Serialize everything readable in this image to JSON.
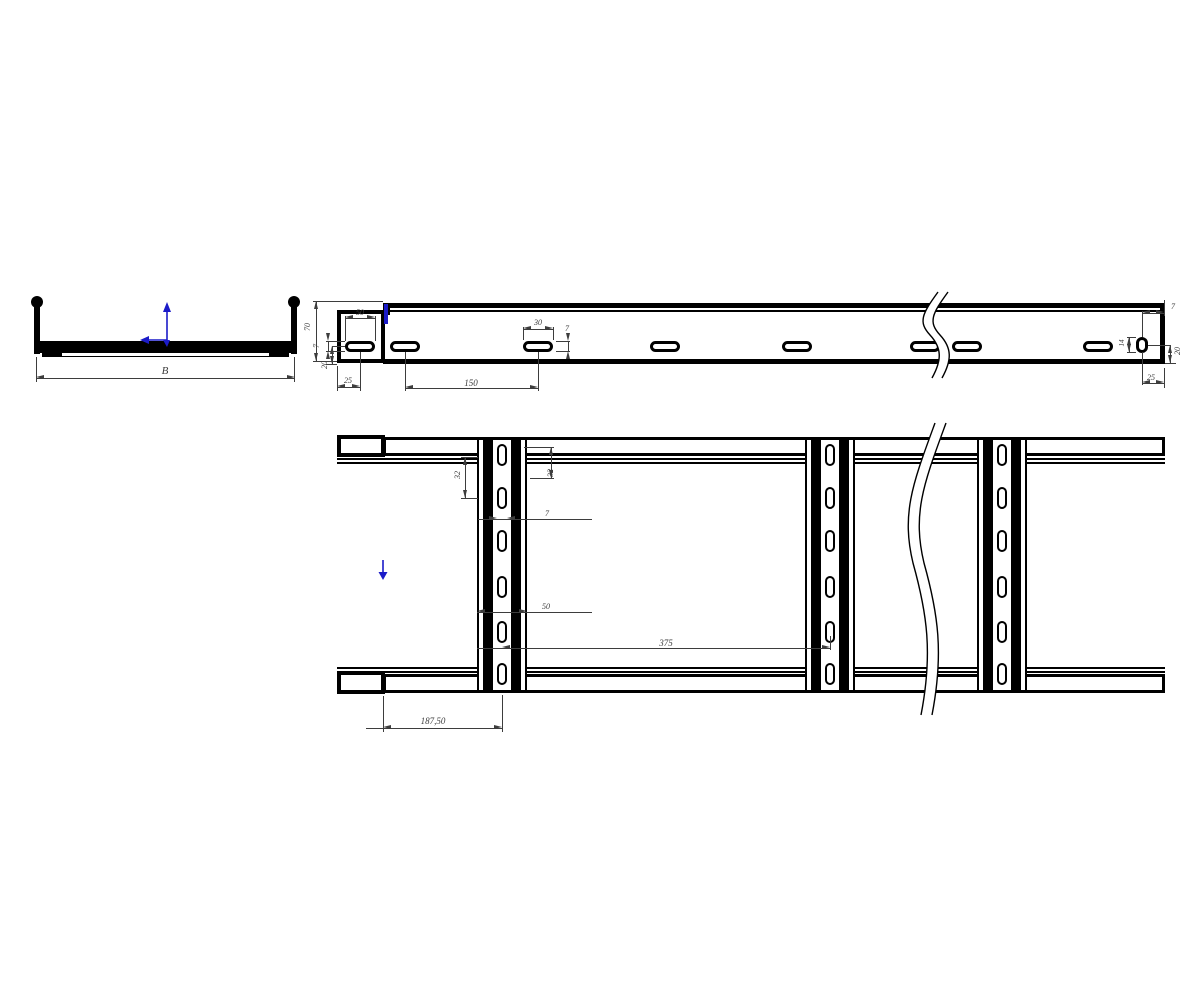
{
  "colors": {
    "line": "#000000",
    "dim": "#3d3d3d",
    "accent_blue": "#1b1bc8",
    "background": "#ffffff"
  },
  "icons": {
    "origin_triad": "origin-triad-icon",
    "flow_arrow": "down-arrow-icon",
    "highlight_edge": "highlighted-edge"
  },
  "views": {
    "cross_section": {
      "dims": {
        "width": "B"
      }
    },
    "side": {
      "dims": {
        "height": "70",
        "slot_height_left": "7",
        "bottom_offset_left": "20",
        "end_to_first_slot": "25",
        "cap_slot_length": "50",
        "slot_length": "30",
        "slot_height": "7",
        "slot_pitch": "150",
        "end_top_right": "7",
        "hole_height": "14",
        "bottom_offset_right": "20",
        "end_to_hole": "25"
      }
    },
    "plan": {
      "dims": {
        "slot_pitch_left": "32",
        "slot_pitch_right": "32",
        "rung_slot_width": "7",
        "rung_width": "50",
        "rung_pitch": "375",
        "end_to_first_rung": "187,50"
      }
    }
  }
}
